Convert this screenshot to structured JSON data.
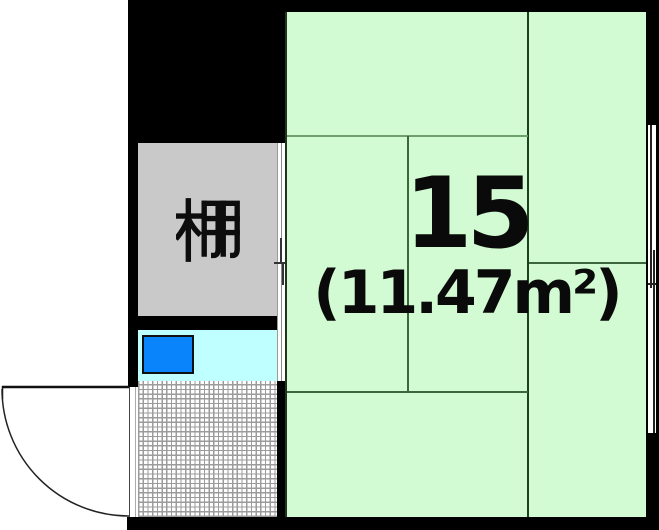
{
  "floor_plan": {
    "room": {
      "number": "15",
      "area_label": "(11.47m²)"
    },
    "shelf": {
      "label": "棚"
    },
    "colors": {
      "room-fill": "#d3fbd3",
      "tatami-dark": "#1e3e1e",
      "tatami-mid": "#3c663c",
      "tatami-light": "#6f9f6f",
      "shelf-fill": "#c9c9c9",
      "kitchen-fill": "#c0ffff",
      "sink-fill": "#0a84fa",
      "wall": "#000000",
      "hatch-line": "#9b9b9b",
      "ink": "#0a0a0a"
    }
  }
}
